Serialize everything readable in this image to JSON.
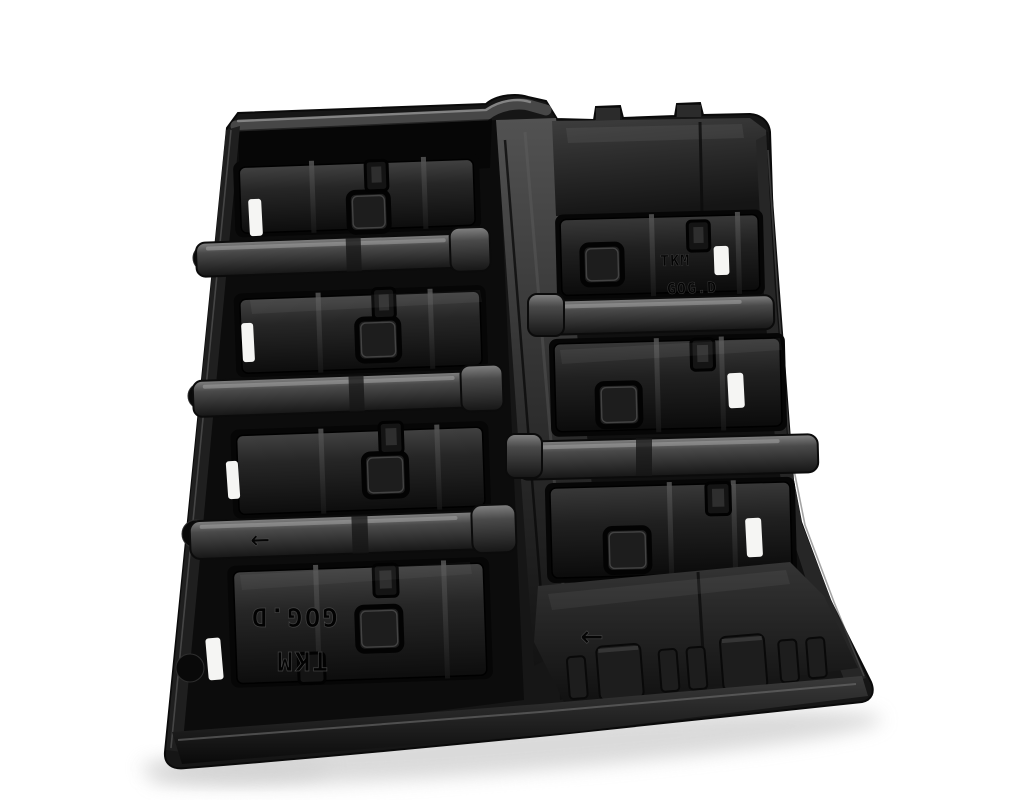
{
  "scene": {
    "subject": "Black vacuum-formed plastic packaging tray with eight rectangular component compartments, photographed at an oblique angle on a seamless white background",
    "object_type": "thermoformed component tray",
    "view": "top-down oblique"
  },
  "colors": {
    "background": "#ffffff",
    "tray_black": "#161616",
    "tray_highlight": "#8f8f8f",
    "label_white": "#f5f5f3",
    "drop_shadow": "#cbcbcb"
  },
  "markings": {
    "mold_code": "GOG.D",
    "brand_code": "TKM",
    "orientation_arrow": "←"
  },
  "structure": {
    "compartment_rows_left": 4,
    "compartment_rows_right": 4,
    "white_label_stickers": 7,
    "square_bosses": 7,
    "embossed_arrows": 2
  }
}
